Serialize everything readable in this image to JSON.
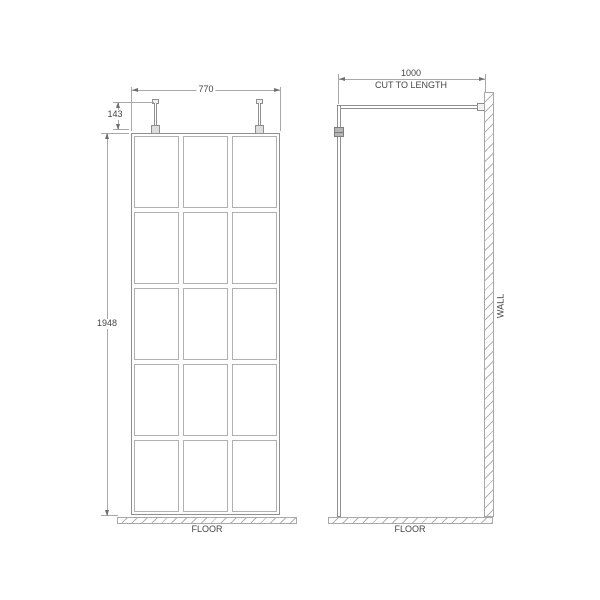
{
  "drawing": {
    "front_view": {
      "width_label": "770",
      "pin_height_label": "143",
      "height_label": "1948",
      "floor_label": "FLOOR",
      "grid": {
        "columns": 3,
        "rows": 5
      }
    },
    "side_view": {
      "arm_length_label": "1000",
      "arm_note": "CUT TO LENGTH",
      "wall_label": "WALL",
      "floor_label": "FLOOR"
    },
    "colors": {
      "line": "#a8a8a8",
      "line_dark": "#8f8f8f",
      "text": "#454545",
      "arrow": "#6e6e6e"
    }
  }
}
